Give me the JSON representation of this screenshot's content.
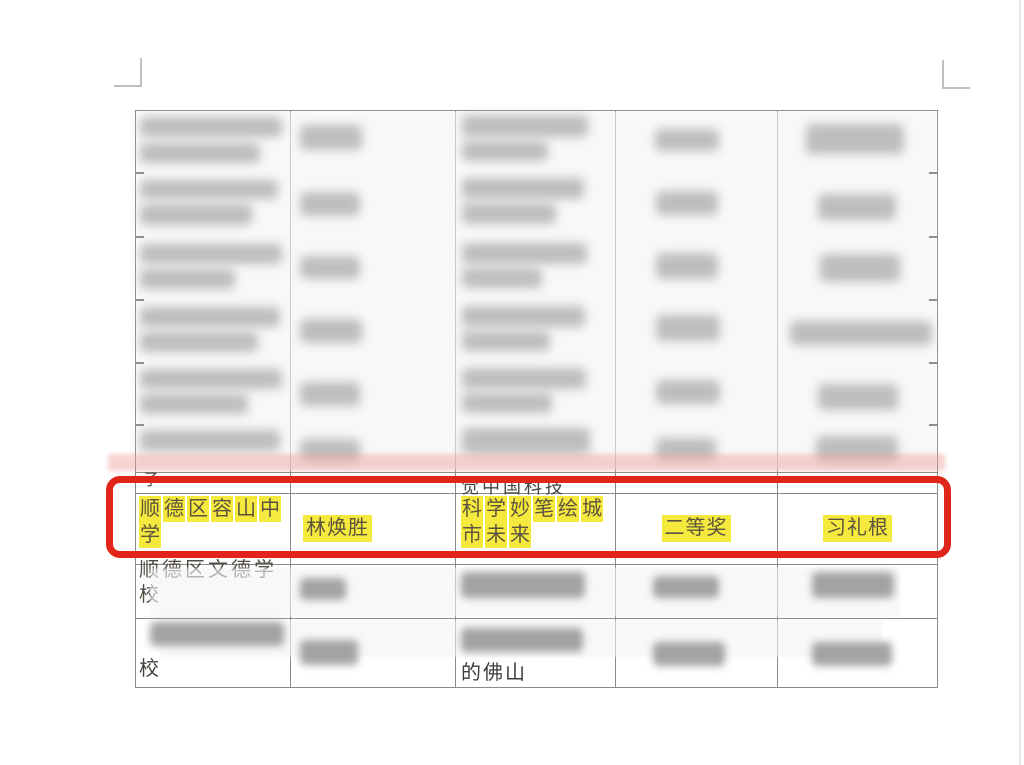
{
  "page": {
    "background": "#ffffff",
    "annotation_color": "#e1251b",
    "highlight_color": "#f4e93c"
  },
  "table": {
    "columns": 5,
    "highlighted_row": {
      "school": "顺德区容山中学",
      "participant": "林焕胜",
      "work_title": "科学妙笔绘城市未来",
      "award": "二等奖",
      "instructor": "习礼根"
    },
    "partial_row_above": {
      "school_fragment": "子",
      "work_fragment": "觉中国科技"
    },
    "partial_row_below": {
      "school": "顺德区文德学校"
    },
    "partial_bottom_row": {
      "school_fragment": "校",
      "work_fragment": "的佛山"
    }
  }
}
